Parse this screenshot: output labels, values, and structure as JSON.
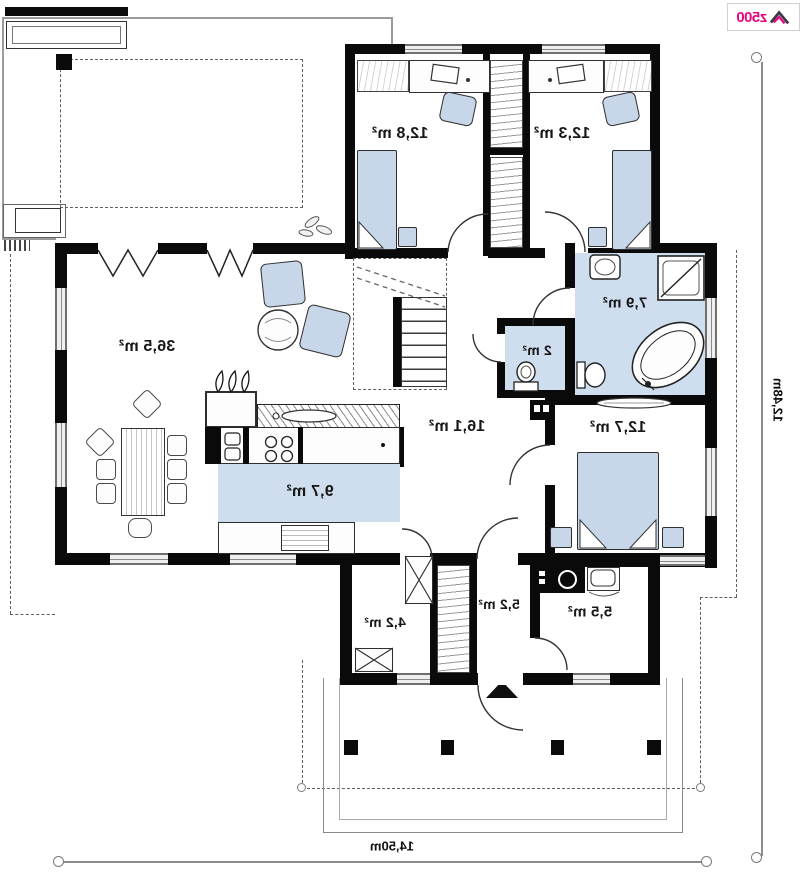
{
  "branding": {
    "logo_text": "z500"
  },
  "rooms": {
    "bedroom1": "12,8 m²",
    "bedroom2": "12,3 m²",
    "living": "36,5 m²",
    "hall": "16,1 m²",
    "kitchen": "9,7 m²",
    "bathroom": "7,9 m²",
    "wc": "2 m²",
    "bedroom3": "12,7 m²",
    "wardrobe": "4,2 m²",
    "entry": "5,2 m²",
    "utility": "5,5 m²"
  },
  "dimensions": {
    "overall_width": "14,50m",
    "overall_depth": "12,48m"
  },
  "colors": {
    "wall": "#0a0a0a",
    "furniture_fill": "#c7d7e9",
    "floor_fill": "#cfdeee",
    "logo_magenta": "#e5097f"
  }
}
